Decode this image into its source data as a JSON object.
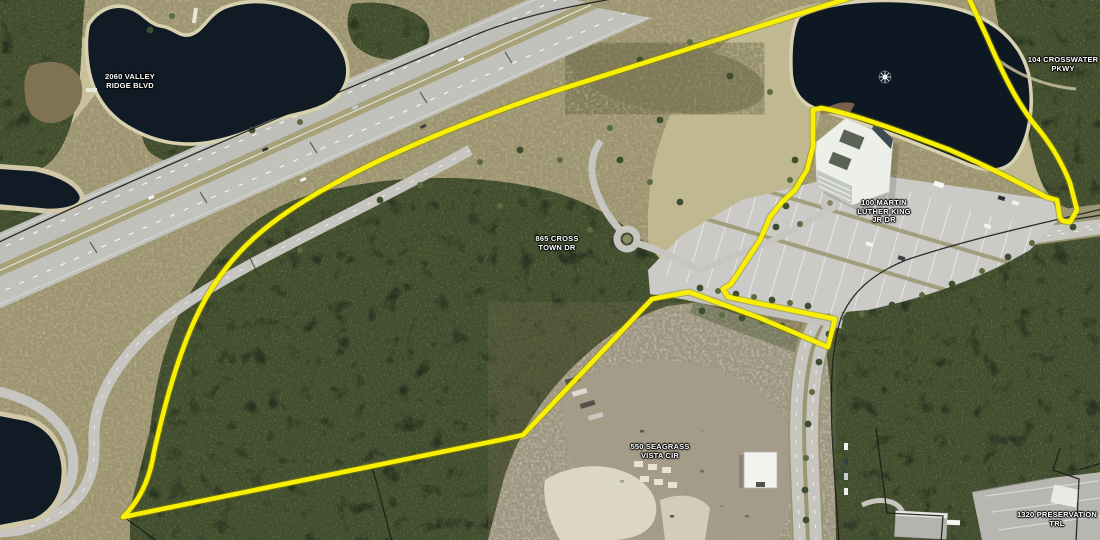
{
  "map": {
    "type": "aerial-satellite-parcel-map",
    "boundary_color": "#f8f000",
    "water_color": "#101b25",
    "labels": {
      "valley_ridge": {
        "line1": "2060 VALLEY",
        "line2": "RIDGE BLVD"
      },
      "crosswater": {
        "line1": "104 CROSSWATER",
        "line2": "PKWY"
      },
      "cross_town": {
        "line1": "865 CROSS",
        "line2": "TOWN DR"
      },
      "mlk": {
        "line1": "100 MARTIN",
        "line2": "LUTHER KING",
        "line3": "JR DR"
      },
      "seagrass": {
        "line1": "550 SEAGRASS",
        "line2": "VISTA CIR"
      },
      "preservation": {
        "line1": "1320 PRESERVATION",
        "line2": "TRL"
      }
    }
  }
}
